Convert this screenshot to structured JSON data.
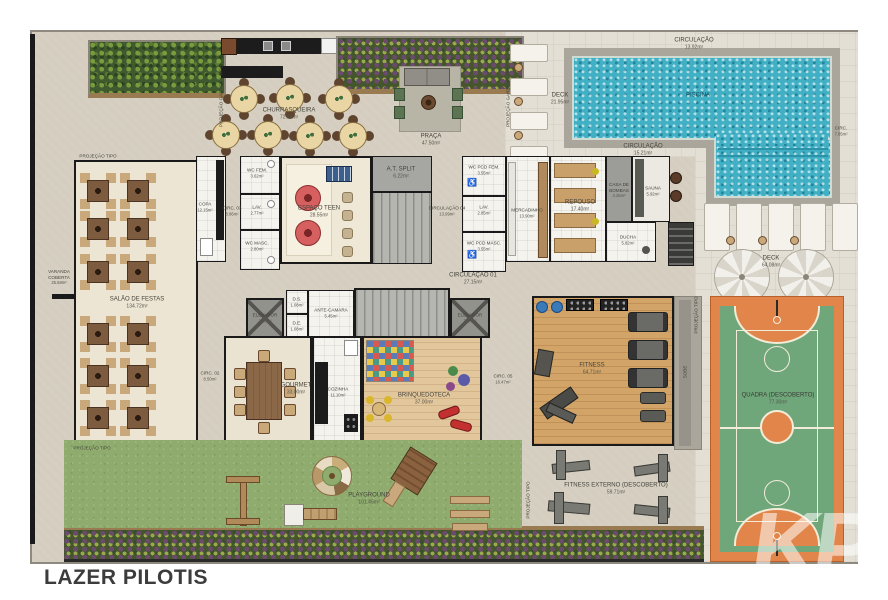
{
  "title": "LAZER PILOTIS",
  "watermark": "KP",
  "colors": {
    "water": "#41b0c5",
    "grass": "#8fac6e",
    "court_orange": "#e2854a",
    "court_green": "#6fa77b",
    "wall": "#1a1a1a",
    "floor_base": "#d5cec0"
  },
  "labels": {
    "circulacao_topo": {
      "name": "CIRCULAÇÃO",
      "area": "13.92m²"
    },
    "piscina": {
      "name": "PISCINA",
      "area": ""
    },
    "circ_direita": {
      "name": "CIRC.",
      "area": "7.85m²"
    },
    "circulacao_piscina": {
      "name": "CIRCULAÇÃO",
      "area": "15.21m²"
    },
    "deck_piscina": {
      "name": "DECK",
      "area": "21.95m²"
    },
    "deck_direito": {
      "name": "DECK",
      "area": "64.08m²"
    },
    "churrasqueira": {
      "name": "CHURRASQUEIRA",
      "area": "72.84m²"
    },
    "praca": {
      "name": "PRAÇA",
      "area": "47.50m²"
    },
    "varanda": {
      "name": "VARANDA COBERTA",
      "area": "25.58m²"
    },
    "salao": {
      "name": "SALÃO DE FESTAS",
      "area": "134.72m²"
    },
    "copa": {
      "name": "COPA",
      "area": "12.15m²"
    },
    "circ03": {
      "name": "CIRC. 03",
      "area": "8.86m²"
    },
    "wc_fem": {
      "name": "WC FEM.",
      "area": "3.62m²"
    },
    "lav1": {
      "name": "LAV.",
      "area": "2.77m²"
    },
    "wc_masc": {
      "name": "WC MASC.",
      "area": "2.80m²"
    },
    "espaco_teen": {
      "name": "ESPAÇO TEEN",
      "area": "28.55m²"
    },
    "at_split": {
      "name": "A.T. SPLIT",
      "area": "6.22m²"
    },
    "circulacao04": {
      "name": "CIRCULAÇÃO 04",
      "area": "13.99m²"
    },
    "wc_pcd_fem": {
      "name": "WC PCD FEM.",
      "area": "3.55m²"
    },
    "lav2": {
      "name": "LAV.",
      "area": "2.85m²"
    },
    "wc_pcd_masc": {
      "name": "WC PCD MASC.",
      "area": "3.55m²"
    },
    "mercadinho": {
      "name": "MERCADINHO",
      "area": "13.90m²"
    },
    "repouso": {
      "name": "REPOUSO",
      "area": "17.40m²"
    },
    "casa_bombas": {
      "name": "CASA DE BOMBAS",
      "area": "4.26m²"
    },
    "sauna": {
      "name": "SAUNA",
      "area": "5.92m²"
    },
    "ducha": {
      "name": "DUCHA",
      "area": "5.82m²"
    },
    "circulacao01": {
      "name": "CIRCULAÇÃO 01",
      "area": "27.15m²"
    },
    "elevador_esq": {
      "name": "ELEVADOR",
      "area": "3.80m²"
    },
    "elevador_dir": {
      "name": "ELEVADOR",
      "area": "3.80m²"
    },
    "ds": {
      "name": "D.S.",
      "area": "1.08m²"
    },
    "de": {
      "name": "D.E.",
      "area": "1.08m²"
    },
    "ante_camara": {
      "name": "ANTE-CAMARA",
      "area": "5.45m²"
    },
    "gourmet": {
      "name": "GOURMET",
      "area": "33.00m²"
    },
    "cozinha": {
      "name": "COZINHA",
      "area": "11.10m²"
    },
    "circ02": {
      "name": "CIRC. 02",
      "area": "8.50m²"
    },
    "brinquedoteca": {
      "name": "BRINQUEDOTECA",
      "area": "37.00m²"
    },
    "circ05": {
      "name": "CIRC. 05",
      "area": "16.47m²"
    },
    "fitness": {
      "name": "FITNESS",
      "area": "64.71m²"
    },
    "playground": {
      "name": "PLAYGROUND",
      "area": "101.45m²"
    },
    "fitness_externo": {
      "name": "FITNESS EXTERNO (DESCOBERTO)",
      "area": "59.71m²"
    },
    "quadra": {
      "name": "QUADRA (DESCOBERTO)",
      "area": "77.30m²"
    },
    "sobe": {
      "name": "SOBE",
      "area": ""
    }
  },
  "annotations": {
    "proj_garden_left": "PROJEÇÃO GARDEN 1 TIPO",
    "proj_garden_right": "PROJEÇÃO GARDEN 1 TIPO",
    "proj_tipo_top": "PROJEÇÃO TIPO",
    "proj_tipo_bottom": "PROJEÇÃO TIPO",
    "proj_tipo_fitness": "PROJEÇÃO TIPO",
    "proj_tipo_externo": "PROJEÇÃO TIPO"
  }
}
